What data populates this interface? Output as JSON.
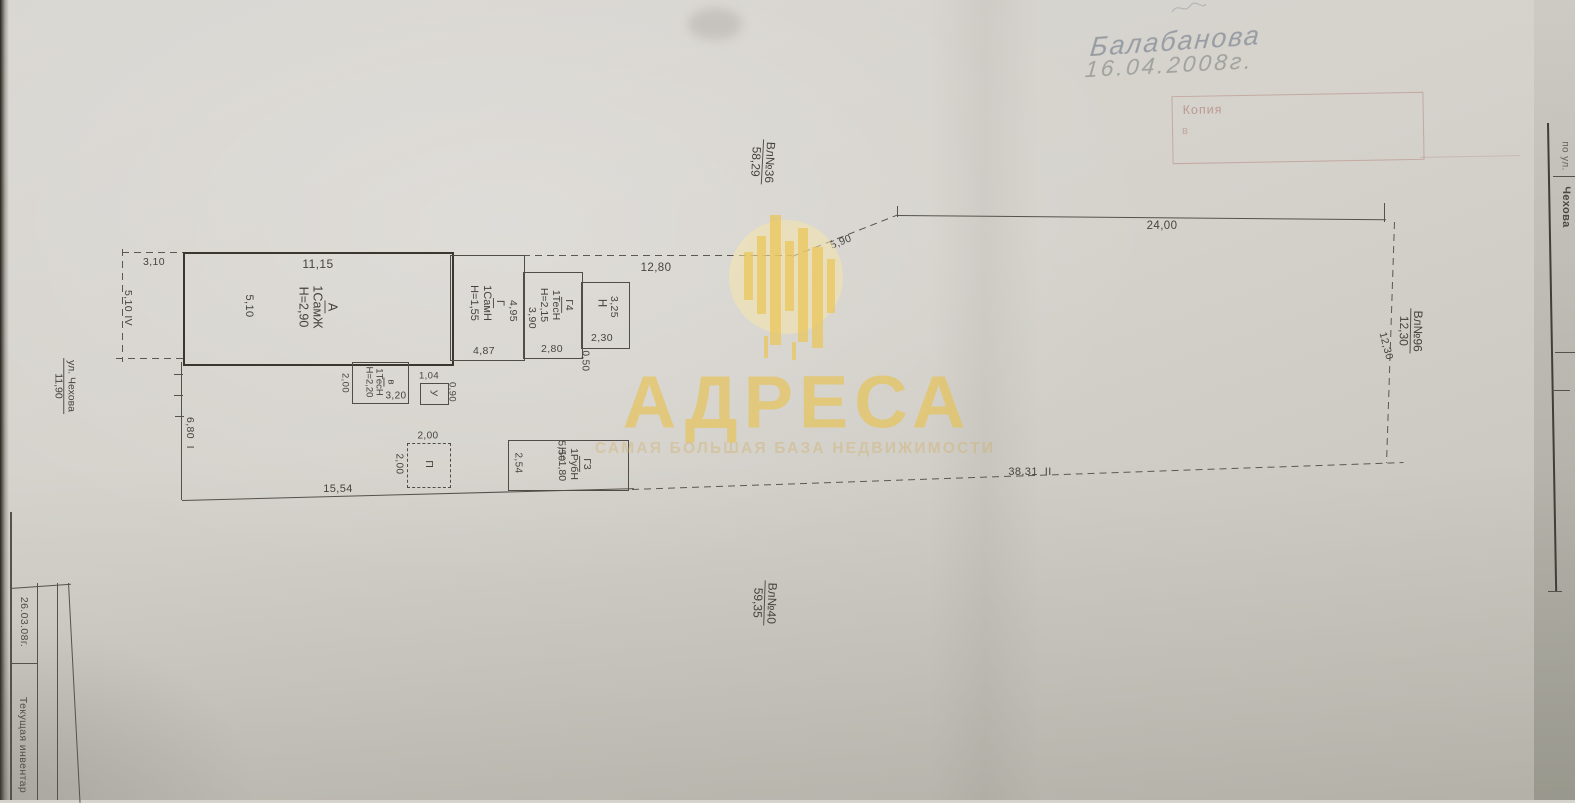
{
  "handwriting": {
    "signature": "Балабанова",
    "date": "16.04.2008г."
  },
  "stamp": {
    "line1": "Копия",
    "line2": "в"
  },
  "plots": {
    "top": {
      "name": "Вл№36",
      "length": "58,29"
    },
    "right": {
      "name": "Вл№96",
      "length": "12,30"
    },
    "bottom": {
      "name": "Вл№40",
      "length": "59,35"
    },
    "street": {
      "name": "ул. Чехова",
      "length": "11,90"
    }
  },
  "buildings": {
    "A": {
      "name": "А",
      "type": "1СамЖ",
      "height": "Н=2,90"
    },
    "G": {
      "name": "Г",
      "type": "1СамН",
      "height": "Н=1,55"
    },
    "G4": {
      "name": "Г4",
      "type": "1ТесН",
      "height": "Н=2,15"
    },
    "N": {
      "name": "Н"
    },
    "V": {
      "name": "в",
      "type": "1ТесН",
      "height": "Н=2,20"
    },
    "U": {
      "name": "У"
    },
    "P": {
      "name": "П"
    },
    "G3": {
      "name": "Г3",
      "type": "1РубН",
      "height": "Н=1,80"
    }
  },
  "dims": {
    "aux_width": "3,10",
    "aux_depth": "5,10",
    "aux_roman": "IV",
    "a_top": "11,15",
    "a_left": "5,10",
    "g_right": "4,95",
    "g_bottom": "4,87",
    "g4_left": "3,90",
    "g4_bottom": "2,80",
    "n_right": "3,25",
    "n_bottom": "2,30",
    "n_offset": "0,50",
    "top_mid": "12,80",
    "top_slope": "5,90",
    "top_right": "24,00",
    "v_left": "2,00",
    "v_bottom": "3,20",
    "u_top": "1,04",
    "u_right": "0,90",
    "p_top": "2,00",
    "p_left": "2,00",
    "g3_top": "5,50",
    "g3_left": "2,54",
    "left_bound": "6,80",
    "left_roman": "I",
    "bottom_left": "15,54",
    "bottom_bound": "38,31",
    "bottom_roman": "II",
    "right_bound": "12,30"
  },
  "watermark": {
    "brand": "АДРЕСА",
    "tagline": "САМАЯ БОЛЬШАЯ БАЗА НЕДВИЖИМОСТИ",
    "gold": "#e9bf40"
  },
  "title_block": {
    "row1": "26.03.08г.",
    "row2": "Текущая инвентар"
  },
  "side_page": {
    "label": "по ул.",
    "street": "Чехова"
  }
}
